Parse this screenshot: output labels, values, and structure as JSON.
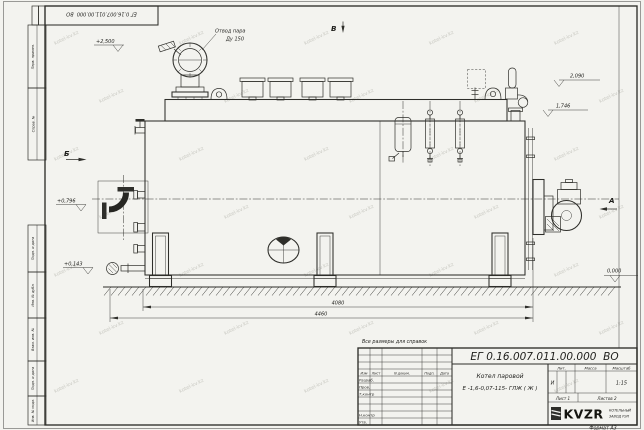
{
  "watermark": {
    "text": "kotel-kv.kz"
  },
  "frame": {
    "stamp_doc_number": "ЕГ 0.16.007.011.00.000  ВО",
    "side_columns": [
      "Перв. примен.",
      "Справ. №",
      "Подп. и дата",
      "Инв. № дубл.",
      "Взам. инв. №",
      "Подп. и дата",
      "Инв. № подл."
    ],
    "format_label": "Формат А3"
  },
  "annotations": {
    "steam_outlet_1": "Отвод пара",
    "steam_outlet_2": "Ду 150",
    "view_a": "А",
    "view_b": "Б",
    "view_v": "В",
    "elev_plus_2500": "+2,500",
    "elev_2090": "2,090",
    "elev_1746": "1,746",
    "elev_plus_0796": "+0,796",
    "elev_plus_0143": "+0,143",
    "elev_0000": "0,000",
    "dim_boiler_length": "4080",
    "dim_overall_length": "4460",
    "note_reference": "Все размеры для справок"
  },
  "title_block": {
    "doc_number": "ЕГ 0.16.007.011.00.000  ВО",
    "product_line_1": "Котел паровой",
    "product_line_2": "Е -1,6-0,07-115- ГЛЖ ( Ж )",
    "header_izm": "Изм",
    "header_list": "Лист",
    "header_ndoc": "N докум.",
    "header_podp": "Подп.",
    "header_data": "Дата",
    "row_razrab": "Разраб.",
    "row_prov": "Пров.",
    "row_tkontr": "Т.контр",
    "row_nkontr": "Н.контр",
    "row_utv": "Утв.",
    "lit_header": "Лит.",
    "mass_header": "Масса",
    "scale_header": "Масштаб",
    "lit_value": "И",
    "scale_value": "1:15",
    "sheet_label": "Лист 1",
    "sheets_label": "Листов 2",
    "logo": "KVZR",
    "logo_sub_1": "КОТЕЛЬНЫЙ",
    "logo_sub_2": "ЗАВОД РЭП"
  }
}
